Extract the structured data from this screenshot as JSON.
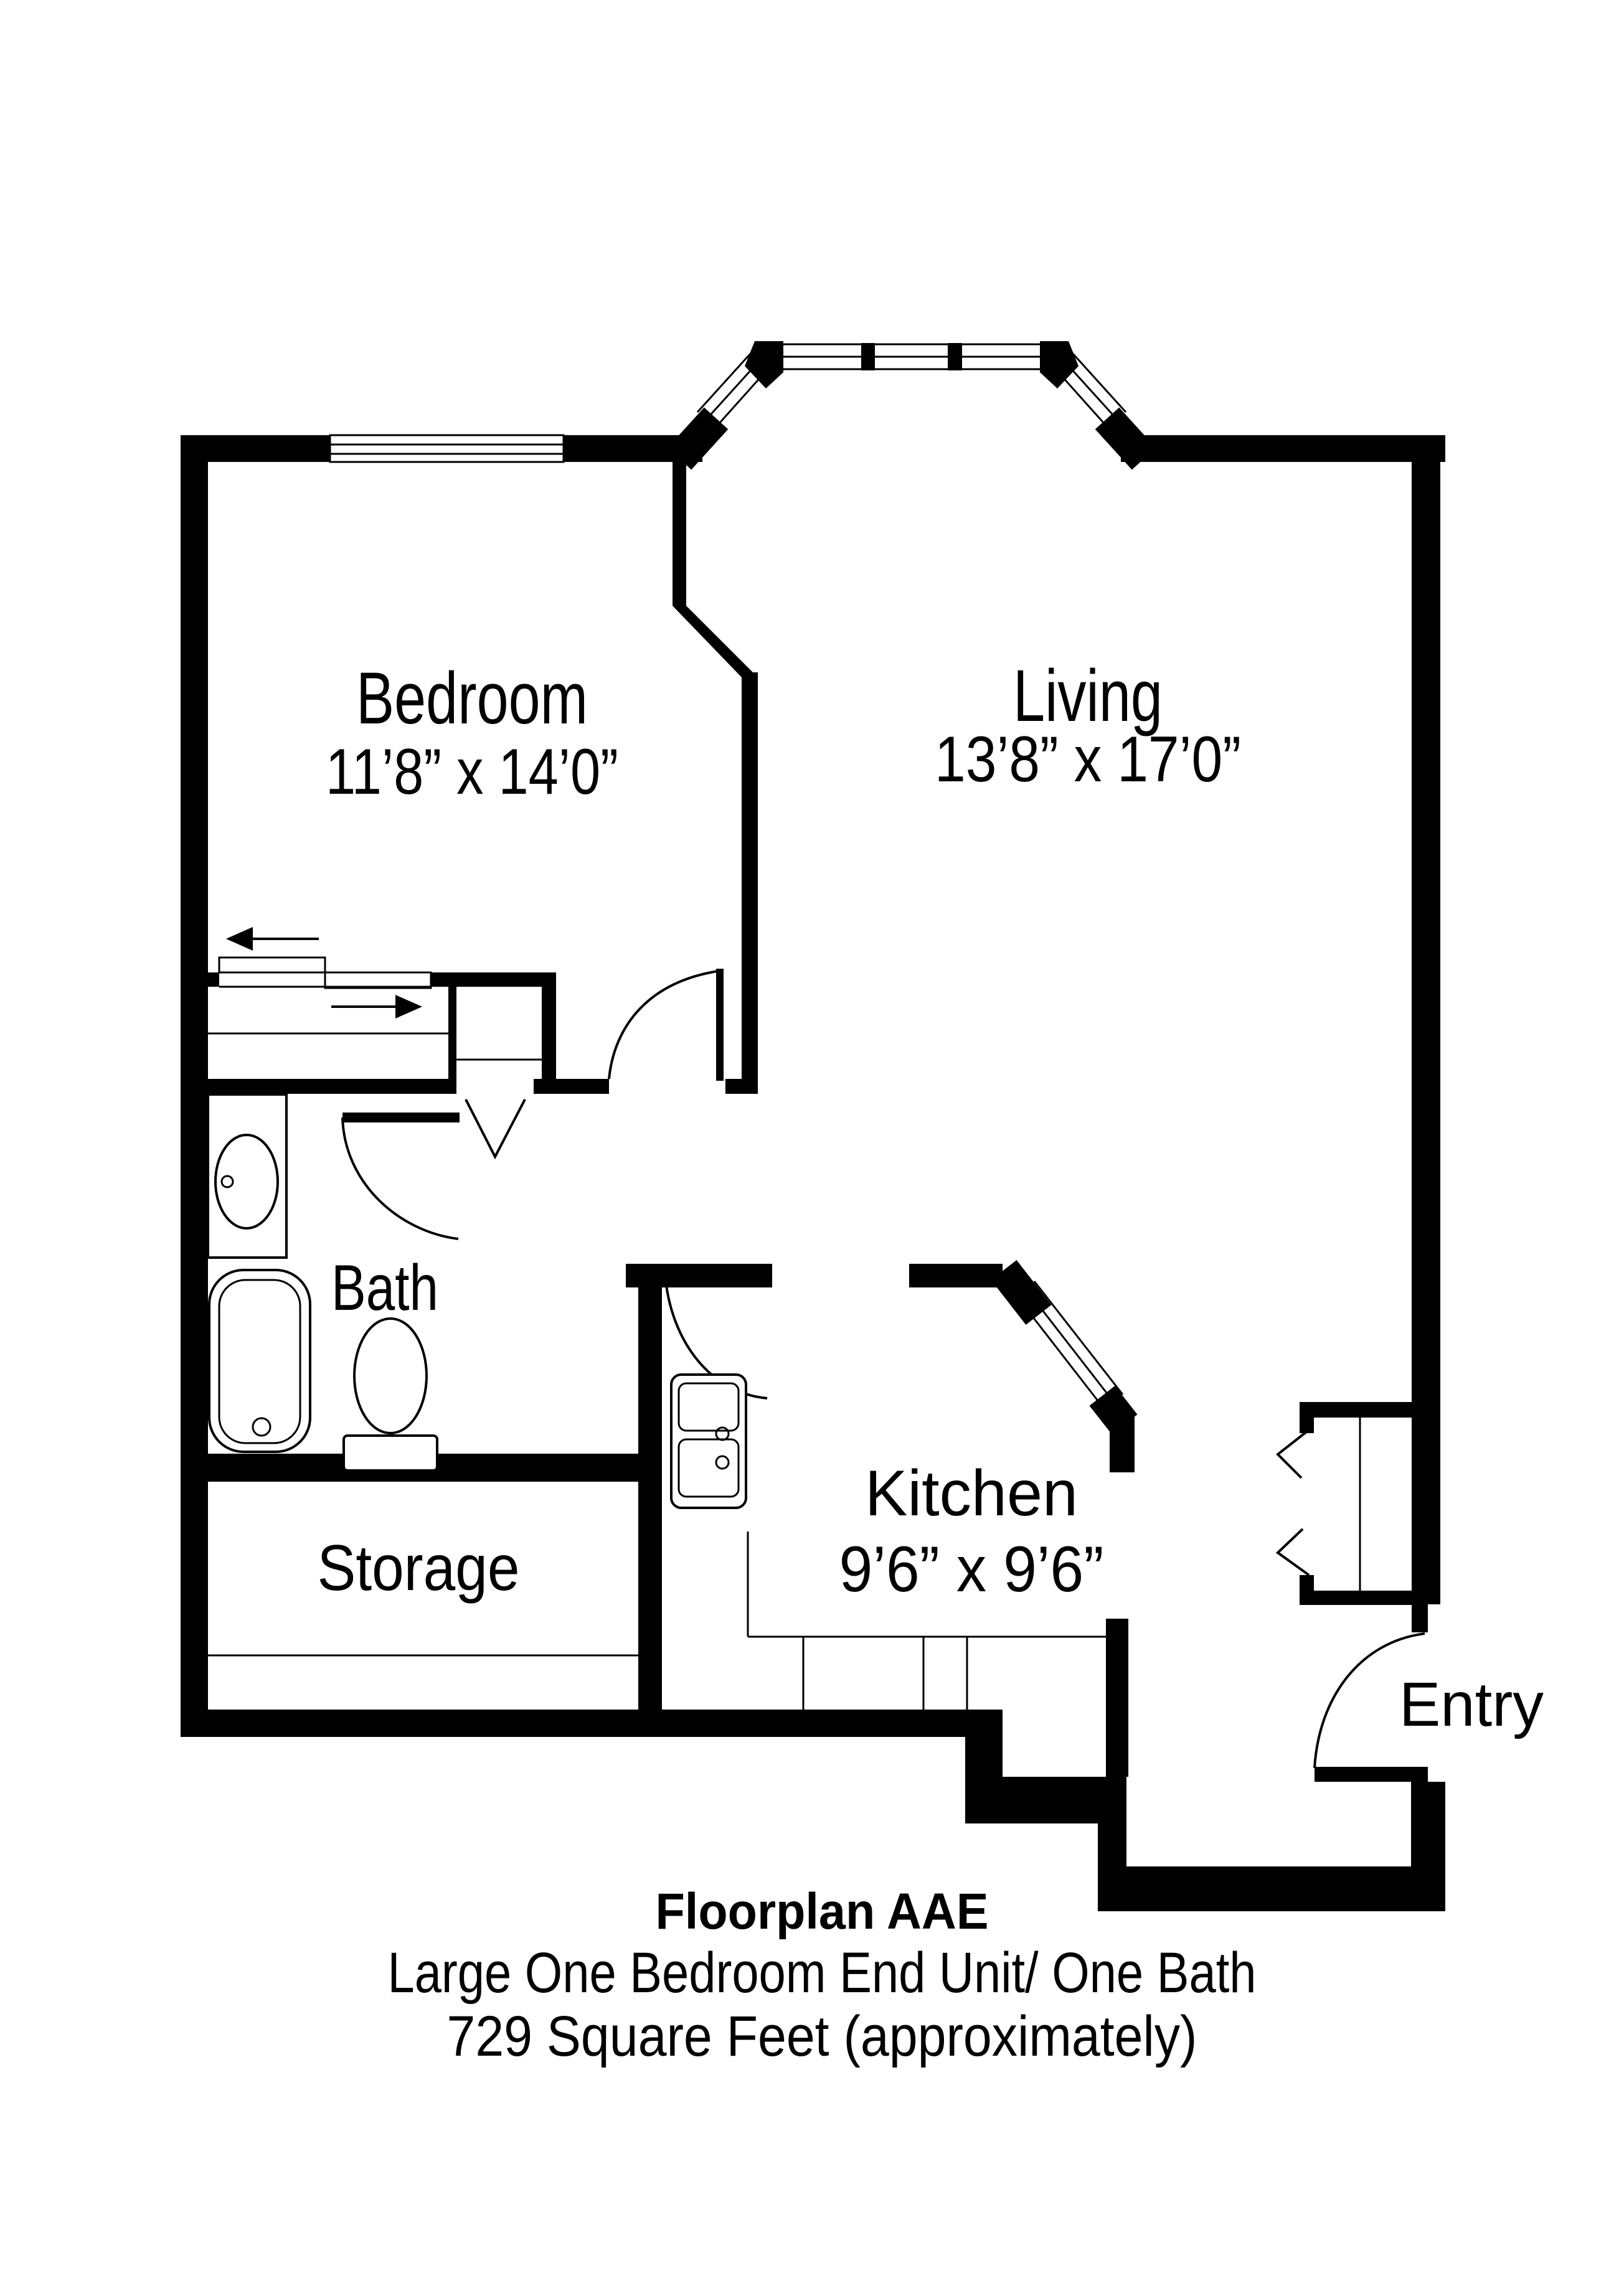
{
  "document": {
    "type": "floorplan",
    "colors": {
      "ink": "#000000",
      "paper": "#ffffff"
    }
  },
  "rooms": [
    {
      "label": "Bedroom",
      "dims": "11’8” x 14’0”"
    },
    {
      "label": "Living",
      "dims": "13’8” x 17’0”"
    },
    {
      "label": "Bath",
      "dims": ""
    },
    {
      "label": "Kitchen",
      "dims": "9’6” x 9’6”"
    },
    {
      "label": "Storage",
      "dims": ""
    },
    {
      "label": "Entry",
      "dims": ""
    }
  ],
  "caption": {
    "title": "Floorplan AAE",
    "line2": "Large One Bedroom End Unit/ One Bath",
    "line3": "729 Square Feet (approximately)"
  },
  "symbols": [
    "bay-window",
    "bedroom-window",
    "sliding-closet-arrows",
    "bifold-door-chevron",
    "entry-closet-bifold-chevrons",
    "bedroom-door-swing",
    "bath-door-swing",
    "kitchen-door-swing",
    "entry-door-swing",
    "bathtub",
    "toilet",
    "vanity-sink",
    "kitchen-double-sink",
    "kitchen-counter",
    "pass-through-window"
  ]
}
